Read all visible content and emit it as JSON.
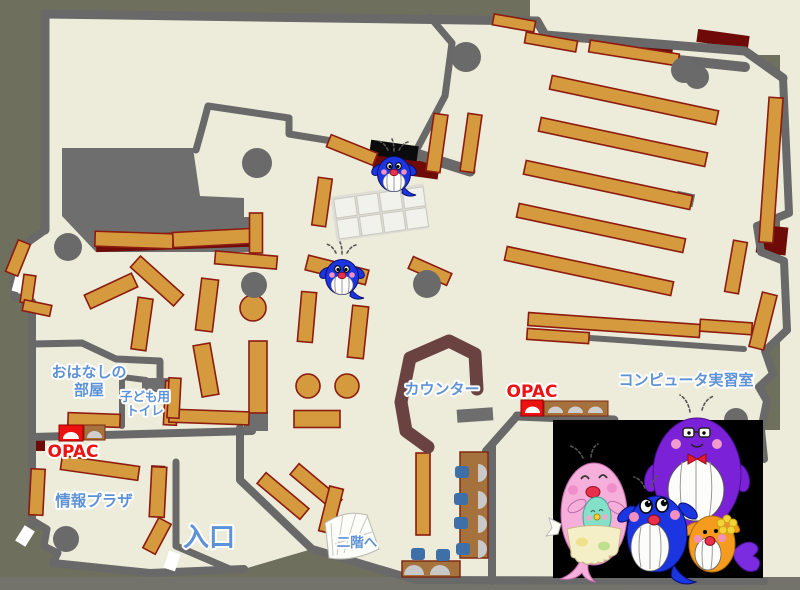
{
  "map_labels": {
    "storytelling_room_line1": "おはなしの",
    "storytelling_room_line2": "部屋",
    "kids_toilet_line1": "子ども用",
    "kids_toilet_line2": "トイレ",
    "opac_left": "OPAC",
    "opac_right": "OPAC",
    "info_plaza": "情報プラザ",
    "entrance": "入口",
    "counter": "カウンター",
    "computer_room": "コンピュータ実習室",
    "to_second_floor": "二階へ"
  },
  "colors": {
    "floor": "#EDECDA",
    "wall_gray": "#696969",
    "outside": "#6F6F5E",
    "bookshelf_tan": "#D49A3D",
    "bookshelf_border": "#8C1B10",
    "accent_dark_red": "#6E0B08",
    "counter_maroon": "#6B4242",
    "label_blue": "#5E92D6",
    "label_red": "#EE1111",
    "chair_blue": "#3E6FA6",
    "desk_brown": "#A5713C",
    "seat_gray": "#C9C9C9",
    "stairs_white": "#FCFCF8",
    "mascot_blue": "#1B35E0",
    "mascot_pink": "#F6AEDA",
    "mascot_purple": "#7B22D8",
    "mascot_orange": "#F59C1E",
    "mascot_teal": "#84E0C8",
    "illustration_bg": "#000000"
  },
  "mascots": {
    "on_map": [
      "blue-whale-waving",
      "blue-whale-waving"
    ],
    "family_illustration": [
      "pink-mother-whale-holding-baby",
      "teal-baby-whale",
      "purple-father-whale-with-glasses-and-bowtie",
      "blue-child-whale",
      "orange-child-whale-with-flower"
    ]
  }
}
